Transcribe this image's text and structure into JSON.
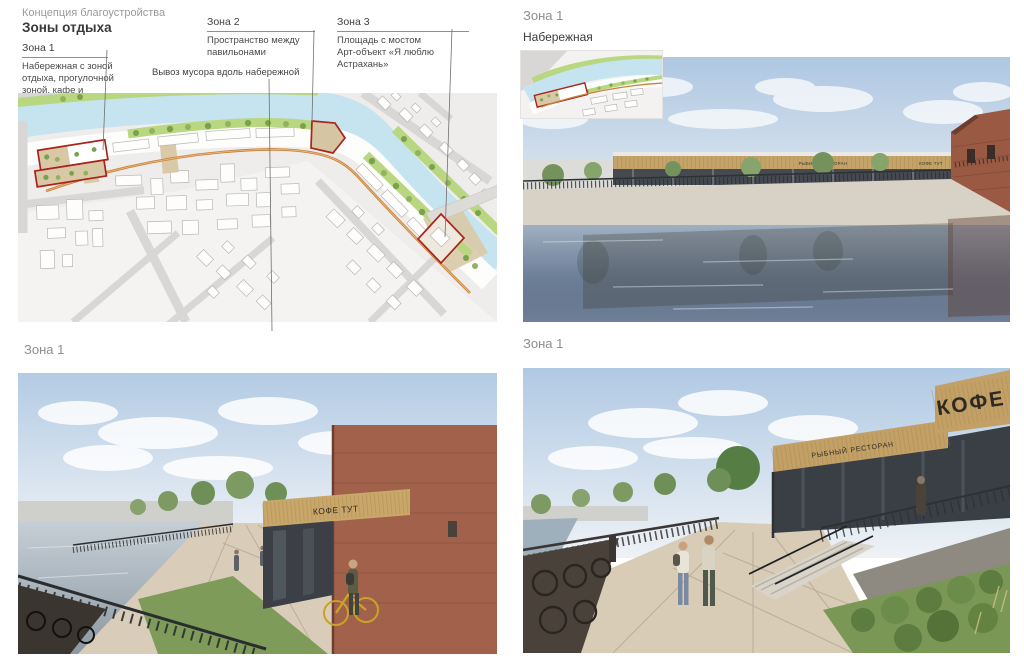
{
  "header": {
    "kicker": "Концепция благоустройства",
    "title": "Зоны отдыха"
  },
  "plan": {
    "zone1": {
      "label": "Зона 1",
      "desc": "Набережная с зоной отдыха, прогулочной зоной, кафе и ресторанами"
    },
    "zone2": {
      "label": "Зона 2",
      "desc": "Пространство между павильонами"
    },
    "zone3": {
      "label": "Зона 3",
      "desc1": "Площадь с мостом",
      "desc2": "Арт-объект «Я люблю Астрахань»"
    },
    "note": "Вывоз мусора вдоль набережной"
  },
  "panels": {
    "top_right": {
      "zone_label": "Зона 1",
      "subtitle": "Набережная"
    },
    "bottom_left": {
      "zone_label": "Зона 1"
    },
    "bottom_right": {
      "zone_label": "Зона 1"
    }
  },
  "signs": {
    "coffee_here": "КОФЕ ТУТ",
    "fish_restaurant": "РЫБНЫЙ РЕСТОРАН",
    "coffee": "КОФЕ"
  },
  "colors": {
    "zone_outline_red": "#a8241c",
    "promenade_orange": "#c9803c",
    "river_blue": "#c5e4f0",
    "greenery_green": "#b9d780",
    "label_gray": "#8e8e8e"
  }
}
